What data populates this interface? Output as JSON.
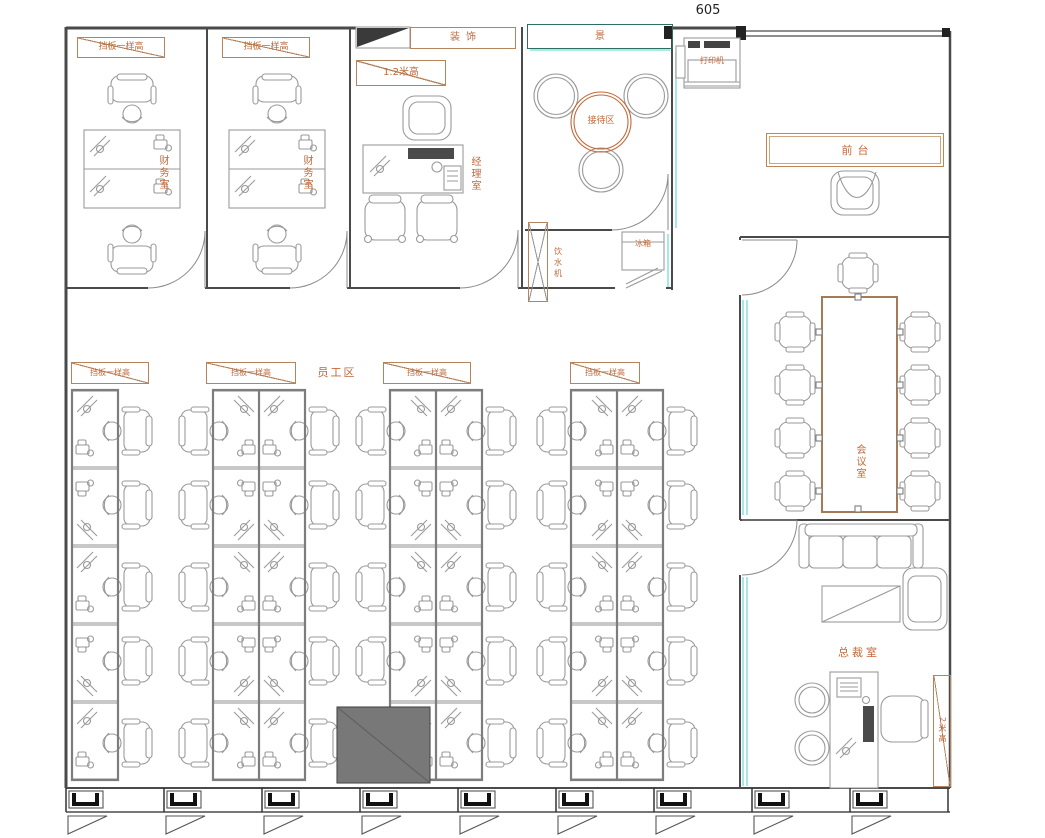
{
  "drawing": {
    "room_number": "605",
    "labels": {
      "partition_same_height": "挡板一样高",
      "partition_1_2m": "1.2米高",
      "decoration": "装饰",
      "view": "景",
      "finance_room": "财务室",
      "manager_room": "经理室",
      "reception_area": "接待区",
      "printer": "打印机",
      "front_desk": "前台",
      "fridge": "冰箱",
      "water_dispenser": "饮水机",
      "staff_area": "员工区",
      "meeting_room": "会议室",
      "president_room": "总裁室",
      "cabinet_2m_high": "2米高"
    },
    "colors": {
      "annotation_text": "#c2693a",
      "annotation_box_border": "#b5845c",
      "view_box_border": "#2f6f5f",
      "glass": "#8fe3e3",
      "wall": "#4a4a4a",
      "furniture": "#9a9a9a",
      "table_border": "#a57a55",
      "column_fill": "#787878"
    }
  }
}
